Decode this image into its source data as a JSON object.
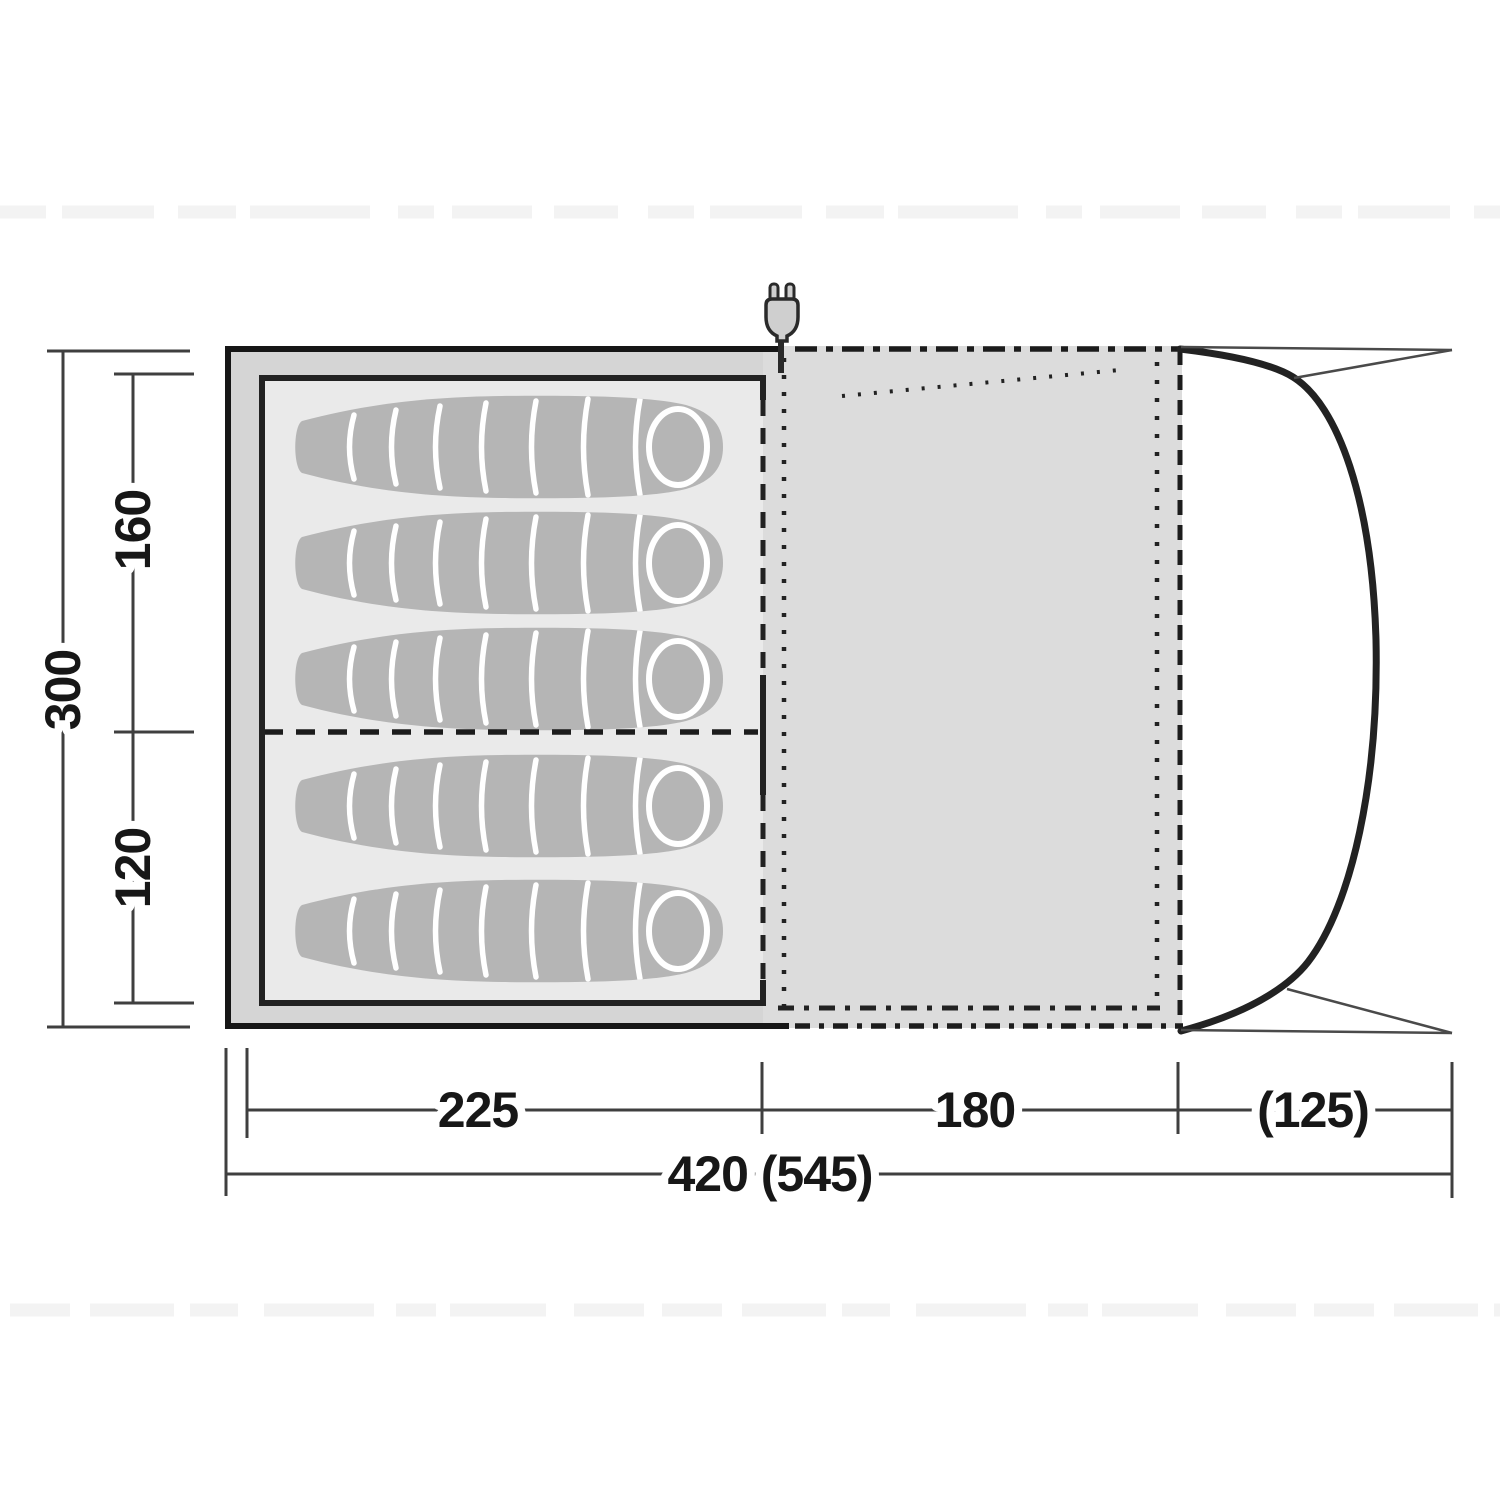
{
  "diagram": {
    "title": "tent-floorplan-top-view",
    "dimensions": {
      "depth_total": "300",
      "depth_inner_front": "160",
      "depth_inner_rear": "120",
      "length_sleeping": "225",
      "length_living": "180",
      "length_canopy": "(125)",
      "length_total": "420 (545)"
    },
    "sleeping_bags": {
      "count": 5,
      "rows": [
        3,
        2
      ],
      "center_x": 512,
      "centers_y": [
        447,
        563,
        679,
        806,
        931
      ]
    },
    "icons": {
      "plug": "power-plug-icon"
    },
    "colors": {
      "outer_shell": "#d5d5d5",
      "living_area": "#dcdcdc",
      "inner_tent_floor": "#eaeaea",
      "sleeping_bag": "#b5b5b5",
      "outline": "#1c1c1c",
      "dim_line": "#3f3f3f"
    }
  }
}
